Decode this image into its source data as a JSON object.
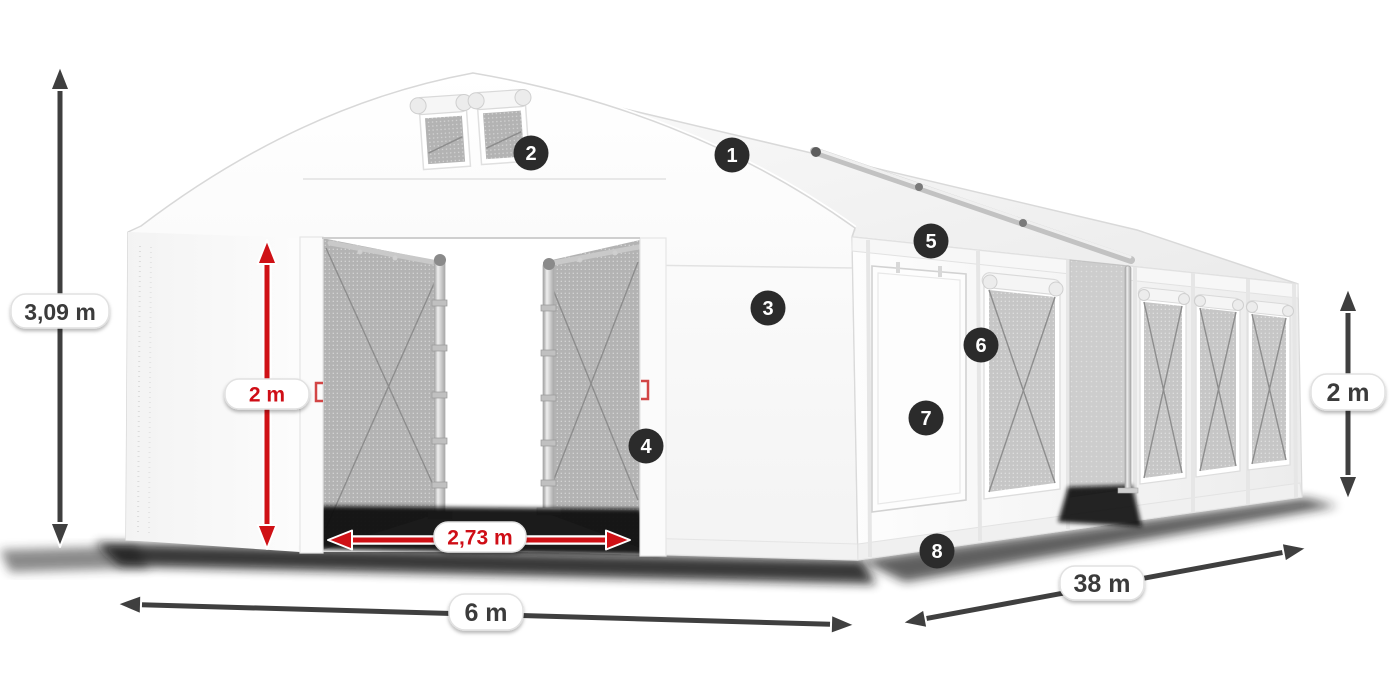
{
  "diagram": {
    "subject": "white storage marquee tent, front-left perspective, with numbered feature callouts and dimension arrows",
    "badges": [
      "1",
      "2",
      "3",
      "4",
      "5",
      "6",
      "7",
      "8"
    ],
    "dimensions": {
      "total_height": "3,09 m",
      "door_height": "2 m",
      "door_width": "2,73 m",
      "width": "6 m",
      "length": "38 m",
      "side_height": "2 m"
    },
    "colors": {
      "background": "#ffffff",
      "dimension_red": "#cf1116",
      "dimension_dark": "#3f3f3f",
      "badge_background": "#2b2b2b",
      "tent_white": "#fdfdfd",
      "mesh_gray": "#b3b3b3"
    }
  }
}
